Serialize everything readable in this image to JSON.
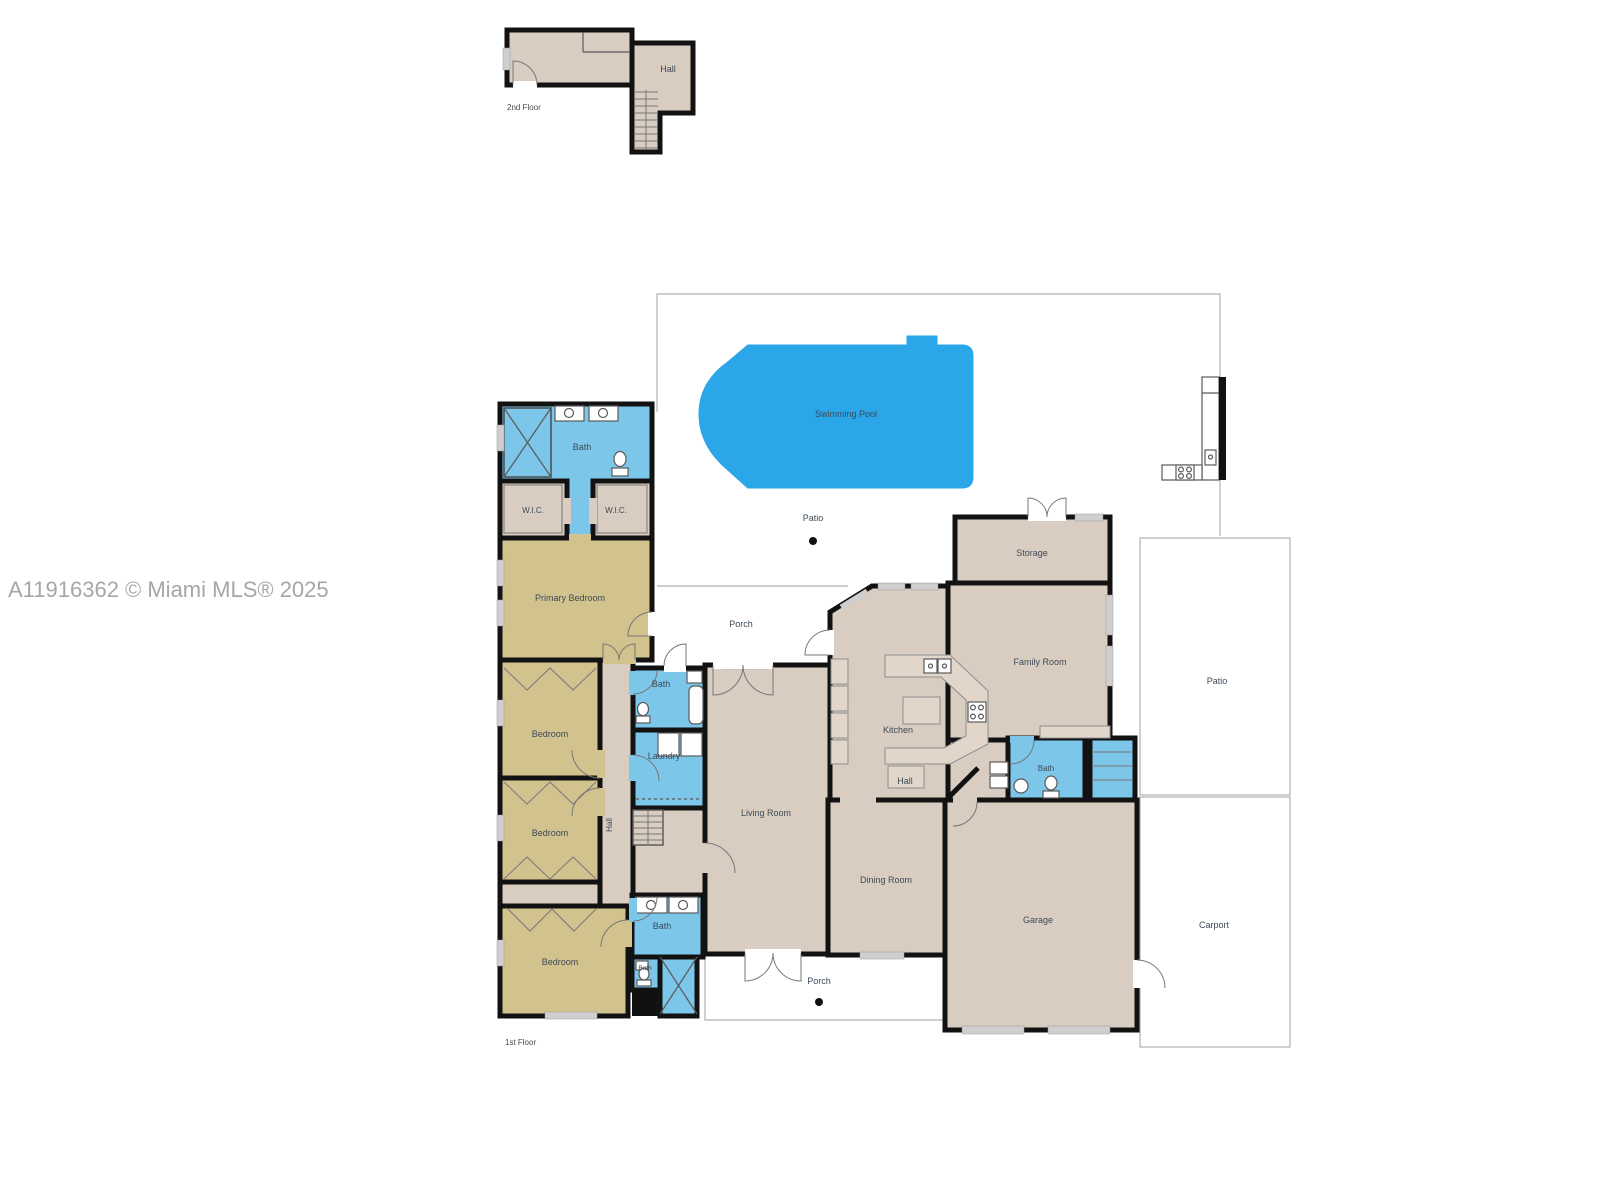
{
  "watermark": "A11916362 © Miami MLS® 2025",
  "second_floor": {
    "floor_label": "2nd Floor",
    "hall": "Hall"
  },
  "first_floor": {
    "floor_label": "1st Floor",
    "outdoor": {
      "swimming_pool": "Swimming Pool",
      "pool_patio": "Patio",
      "upper_porch": "Porch",
      "side_patio": "Patio",
      "carport": "Carport",
      "lower_porch": "Porch"
    },
    "rooms": {
      "primary_bath": "Bath",
      "wic_left": "W.I.C.",
      "wic_right": "W.I.C.",
      "primary_bedroom": "Primary Bedroom",
      "bedroom_top": "Bedroom",
      "bedroom_middle": "Bedroom",
      "bedroom_bottom": "Bedroom",
      "hall_bedroom_wing": "Hall",
      "hall_bath": "Bath",
      "laundry": "Laundry",
      "lower_bath": "Bath",
      "small_bath": "Bath",
      "living_room": "Living Room",
      "kitchen": "Kitchen",
      "center_hall": "Hall",
      "family_room": "Family Room",
      "storage": "Storage",
      "garage_bath": "Bath",
      "dining_room": "Dining Room",
      "garage": "Garage"
    }
  },
  "colors": {
    "pool": "#2ba6e9",
    "wet": "#7cc6ea",
    "bedroom": "#d2c28e",
    "room": "#d9ccc1",
    "wall": "#121212",
    "outline": "#b0b0b0",
    "label": "#3d4a57",
    "watermark": "#a6a6a6"
  }
}
